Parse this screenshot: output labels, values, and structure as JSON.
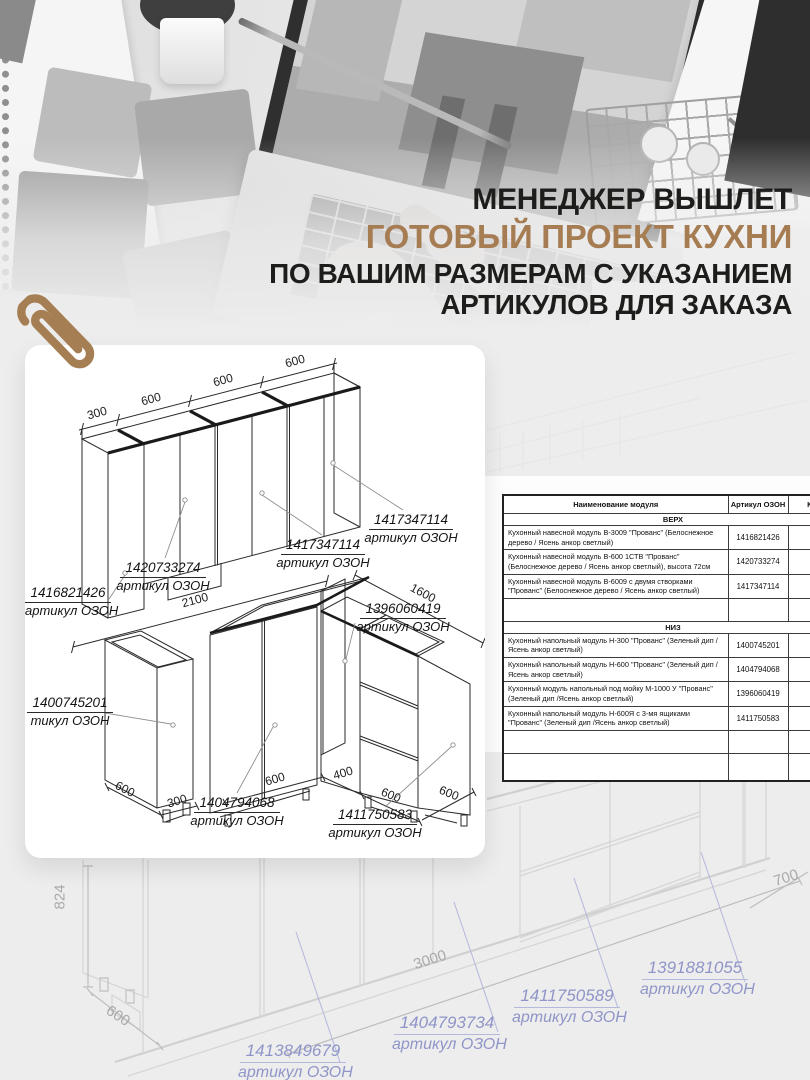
{
  "headline": {
    "line1": "МЕНЕДЖЕР ВЫШЛЕТ",
    "line2": "ГОТОВЫЙ ПРОЕКТ КУХНИ",
    "line3": "ПО ВАШИМ РАЗМЕРАМ С УКАЗАНИЕМ",
    "line4": "АРТИКУЛОВ ДЛЯ ЗАКАЗА",
    "accent_color": "#a67c52"
  },
  "blueprint_card": {
    "top_diagram": {
      "dims": [
        "300",
        "600",
        "600",
        "600"
      ],
      "labels": [
        {
          "article": "1416821426",
          "caption": "артикул ОЗОН"
        },
        {
          "article": "1420733274",
          "caption": "артикул ОЗОН"
        },
        {
          "article": "1417347114",
          "caption": "артикул ОЗОН"
        },
        {
          "article": "1417347114",
          "caption": "артикул ОЗОН"
        }
      ]
    },
    "bottom_diagram": {
      "dims": {
        "total_left": "2100",
        "total_right": "1600",
        "left_depth": "600",
        "left_width": "300",
        "doors": "600",
        "corner": "400",
        "drawers": "600",
        "right_depth": "600"
      },
      "labels": [
        {
          "article": "1400745201",
          "caption": "тикул ОЗОН"
        },
        {
          "article": "1396060419",
          "caption": "артикул ОЗОН"
        },
        {
          "article": "1404794068",
          "caption": "артикул ОЗОН"
        },
        {
          "article": "1411750583",
          "caption": "артикул ОЗОН"
        }
      ]
    }
  },
  "spec_table": {
    "headers": [
      "Наименование модуля",
      "Артикул ОЗОН",
      "Кол-"
    ],
    "section_top": "ВЕРХ",
    "rows_top": [
      {
        "name": "Кухонный навесной модуль В-3009 \"Прованс\" (Белоснежное дерево / Ясень анкор светлый)",
        "article": "1416821426"
      },
      {
        "name": "Кухонный навесной модуль В-600 1СТВ \"Прованс\" (Белоснежное дерево / Ясень анкор светлый), высота 72см",
        "article": "1420733274"
      },
      {
        "name": "Кухонный навесной модуль В-6009 с двумя створками \"Прованс\" (Белоснежное дерево / Ясень анкор светлый)",
        "article": "1417347114"
      }
    ],
    "section_bottom": "НИЗ",
    "rows_bottom": [
      {
        "name": "Кухонный напольный модуль Н-300 \"Прованс\" (Зеленый дип /Ясень анкор светлый)",
        "article": "1400745201"
      },
      {
        "name": "Кухонный напольный модуль Н-600 \"Прованс\" (Зеленый дип /Ясень анкор светлый)",
        "article": "1404794068"
      },
      {
        "name": "Кухонный модуль напольный под мойку М-1000 У \"Прованс\" (Зеленый дип /Ясень анкор светлый)",
        "article": "1396060419"
      },
      {
        "name": "Кухонный напольный модуль Н-600Я с 3-мя ящиками \"Прованс\" (Зеленый дип /Ясень анкор светлый)",
        "article": "1411750583"
      }
    ]
  },
  "background_diagram": {
    "dims": {
      "height": "824",
      "depth": "600",
      "length": "3000",
      "side": "700"
    },
    "label_color": "#8f95c8",
    "labels": [
      {
        "article": "1413849679",
        "caption": "артикул ОЗОН"
      },
      {
        "article": "1404793734",
        "caption": "артикул ОЗОН"
      },
      {
        "article": "1411750589",
        "caption": "артикул ОЗОН"
      },
      {
        "article": "1391881055",
        "caption": "артикул ОЗОН"
      }
    ]
  }
}
